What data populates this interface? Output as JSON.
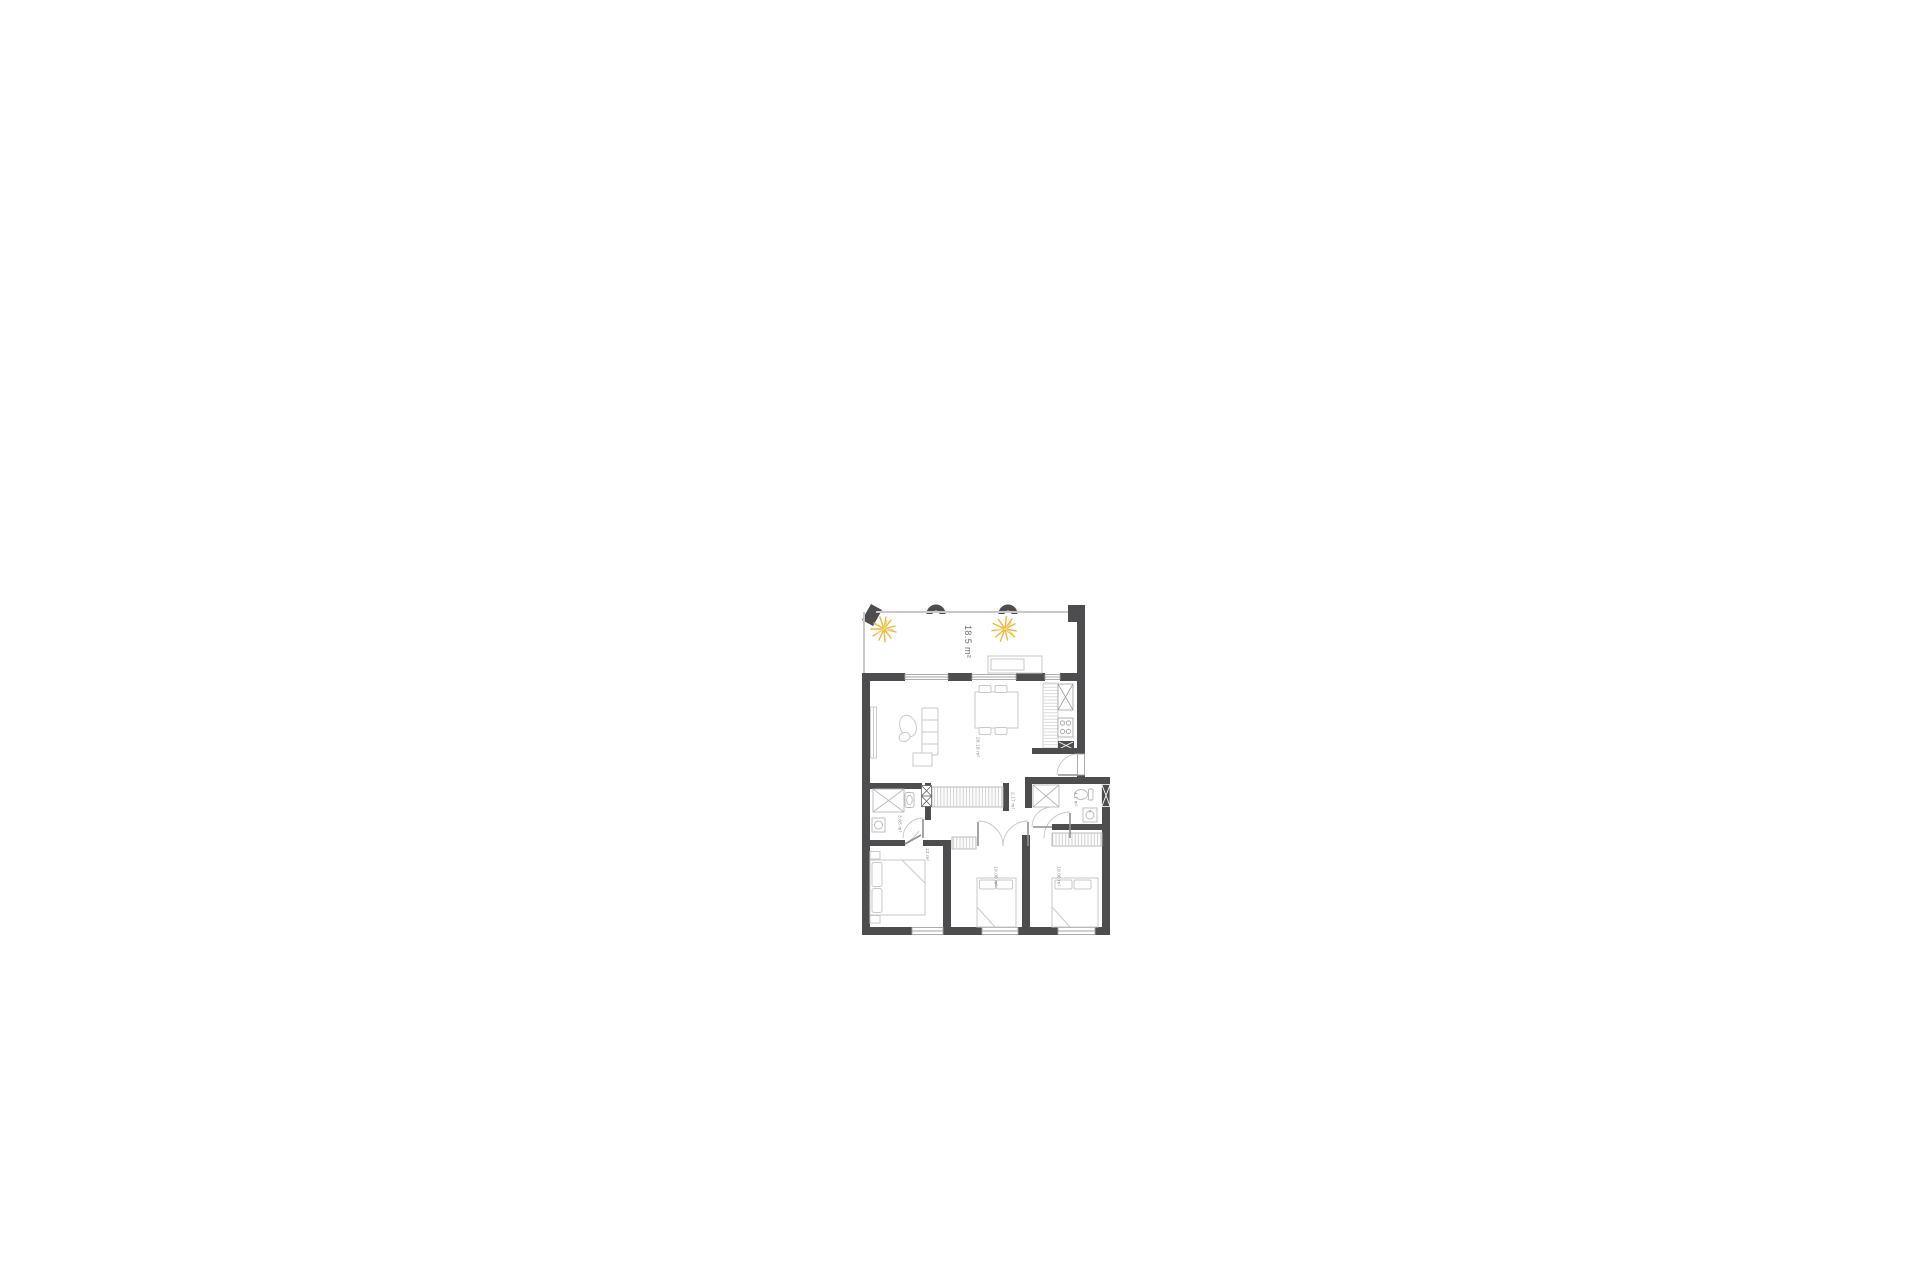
{
  "floorplan": {
    "rooms": {
      "terrace": {
        "area": "18.5 m²"
      },
      "living": {
        "area": "28.18 m²"
      },
      "hall": {
        "area": "2.17 m²"
      },
      "wc": {
        "area": "4.1 m²"
      },
      "bathroom": {
        "area": "3.65 m²"
      },
      "bedroom_left": {
        "area": "12 m²"
      },
      "bedroom_middle": {
        "area": "10.08 m²"
      },
      "bedroom_right": {
        "area": "10.08 m²"
      }
    },
    "colors": {
      "wall": "#4d4d4f",
      "furniture": "#c9c9c9",
      "fixture": "#b9b9b9",
      "window": "#a3a3a3",
      "door": "#c6c6c6",
      "door_leaf": "#8f8f8f",
      "label": "#8a8a8a",
      "label_large": "#6e6e6e",
      "plant": "#e8ba3c",
      "plant_light": "#f4d77d"
    }
  }
}
